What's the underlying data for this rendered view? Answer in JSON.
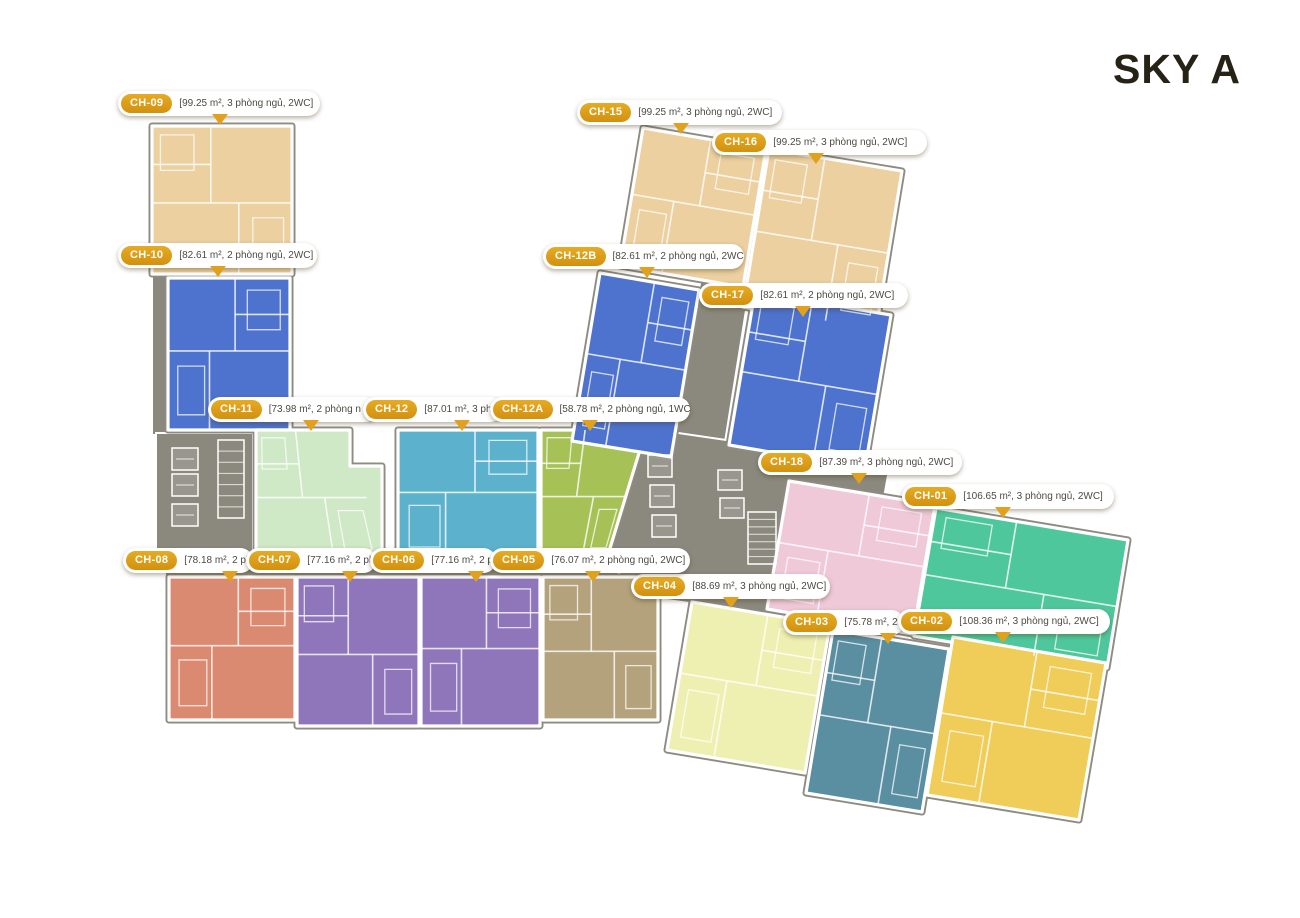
{
  "title": {
    "text": "SKY A"
  },
  "palette": {
    "pill": "#dd9e14",
    "arrow": "#e2a11c",
    "bubble_text": "#4d4a42",
    "core": "#8b897e",
    "outline": "#8e8c82",
    "wall": "#ffffff",
    "background": "#ffffff"
  },
  "units": [
    {
      "id": "CH-09",
      "color": "#ecd0a0",
      "points": [
        [
          152,
          126
        ],
        [
          292,
          126
        ],
        [
          292,
          274
        ],
        [
          152,
          274
        ]
      ]
    },
    {
      "id": "CH-10",
      "color": "#4e73cf",
      "points": [
        [
          168,
          278
        ],
        [
          290,
          278
        ],
        [
          290,
          430
        ],
        [
          168,
          430
        ]
      ]
    },
    {
      "id": "CH-11",
      "color": "#cfe8c6",
      "points": [
        [
          256,
          430
        ],
        [
          350,
          430
        ],
        [
          350,
          466
        ],
        [
          382,
          466
        ],
        [
          382,
          560
        ],
        [
          256,
          560
        ]
      ]
    },
    {
      "id": "CH-12",
      "color": "#5cb2cd",
      "points": [
        [
          398,
          430
        ],
        [
          538,
          430
        ],
        [
          538,
          560
        ],
        [
          398,
          560
        ]
      ]
    },
    {
      "id": "CH-12A",
      "color": "#a6c257",
      "points": [
        [
          541,
          430
        ],
        [
          646,
          430
        ],
        [
          607,
          558
        ],
        [
          541,
          558
        ]
      ]
    },
    {
      "id": "CH-08",
      "color": "#db8a72",
      "points": [
        [
          169,
          577
        ],
        [
          295,
          577
        ],
        [
          295,
          720
        ],
        [
          169,
          720
        ]
      ]
    },
    {
      "id": "CH-07",
      "color": "#8f76ba",
      "points": [
        [
          297,
          577
        ],
        [
          419,
          577
        ],
        [
          419,
          726
        ],
        [
          297,
          726
        ]
      ]
    },
    {
      "id": "CH-06",
      "color": "#8f76ba",
      "points": [
        [
          421,
          577
        ],
        [
          540,
          577
        ],
        [
          540,
          726
        ],
        [
          421,
          726
        ]
      ]
    },
    {
      "id": "CH-05",
      "color": "#b4a27c",
      "points": [
        [
          543,
          577
        ],
        [
          658,
          577
        ],
        [
          658,
          720
        ],
        [
          543,
          720
        ]
      ]
    },
    {
      "id": "CH-15",
      "color": "#ecd0a0",
      "points": [
        [
          643,
          128
        ],
        [
          766,
          149
        ],
        [
          743,
          287
        ],
        [
          620,
          266
        ]
      ]
    },
    {
      "id": "CH-16",
      "color": "#ecd0a0",
      "points": [
        [
          769,
          149
        ],
        [
          902,
          171
        ],
        [
          876,
          329
        ],
        [
          743,
          307
        ]
      ]
    },
    {
      "id": "CH-12B",
      "color": "#4e73cf",
      "points": [
        [
          600,
          273
        ],
        [
          699,
          290
        ],
        [
          671,
          457
        ],
        [
          572,
          441
        ]
      ]
    },
    {
      "id": "CH-17",
      "color": "#4e73cf",
      "points": [
        [
          755,
          292
        ],
        [
          891,
          315
        ],
        [
          865,
          468
        ],
        [
          729,
          445
        ]
      ]
    },
    {
      "id": "CH-18",
      "color": "#f0c9d8",
      "points": [
        [
          789,
          481
        ],
        [
          935,
          505
        ],
        [
          913,
          634
        ],
        [
          767,
          609
        ]
      ]
    },
    {
      "id": "CH-01",
      "color": "#4fc79c",
      "points": [
        [
          936,
          508
        ],
        [
          1128,
          540
        ],
        [
          1107,
          668
        ],
        [
          914,
          636
        ]
      ]
    },
    {
      "id": "CH-04",
      "color": "#eef0b2",
      "points": [
        [
          692,
          602
        ],
        [
          830,
          625
        ],
        [
          805,
          773
        ],
        [
          667,
          750
        ]
      ]
    },
    {
      "id": "CH-03",
      "color": "#5a8ea1",
      "points": [
        [
          833,
          630
        ],
        [
          949,
          649
        ],
        [
          922,
          812
        ],
        [
          806,
          793
        ]
      ]
    },
    {
      "id": "CH-02",
      "color": "#efcd58",
      "points": [
        [
          953,
          637
        ],
        [
          1106,
          663
        ],
        [
          1079,
          820
        ],
        [
          927,
          795
        ]
      ]
    }
  ],
  "cores": [
    {
      "name": "corridor-left",
      "points": [
        [
          152,
          248
        ],
        [
          168,
          248
        ],
        [
          168,
          435
        ],
        [
          152,
          435
        ]
      ]
    },
    {
      "name": "core-left",
      "points": [
        [
          156,
          433
        ],
        [
          253,
          433
        ],
        [
          253,
          568
        ],
        [
          156,
          568
        ]
      ]
    },
    {
      "name": "corridor-band-left",
      "points": [
        [
          165,
          560
        ],
        [
          645,
          560
        ],
        [
          645,
          578
        ],
        [
          165,
          578
        ]
      ]
    },
    {
      "name": "corridor-right",
      "points": [
        [
          701,
          277
        ],
        [
          750,
          285
        ],
        [
          712,
          524
        ],
        [
          663,
          516
        ]
      ]
    },
    {
      "name": "core-center",
      "points": [
        [
          644,
          428
        ],
        [
          890,
          464
        ],
        [
          880,
          520
        ],
        [
          770,
          614
        ],
        [
          645,
          597
        ],
        [
          600,
          556
        ]
      ]
    }
  ],
  "core_details": {
    "elevators": [
      [
        172,
        448,
        26,
        22
      ],
      [
        172,
        474,
        26,
        22
      ],
      [
        172,
        504,
        26,
        22
      ],
      [
        648,
        455,
        24,
        22
      ],
      [
        650,
        485,
        24,
        22
      ],
      [
        652,
        515,
        24,
        22
      ],
      [
        718,
        470,
        24,
        20
      ],
      [
        720,
        498,
        24,
        20
      ]
    ],
    "stairs": [
      [
        218,
        440,
        26,
        78
      ],
      [
        748,
        512,
        28,
        52
      ]
    ]
  },
  "labels": [
    {
      "unit": "CH-09",
      "pill": "CH-09",
      "info": "[99.25 m², 3 phòng ngủ, 2WC]",
      "x": 118,
      "y": 91,
      "w": 202,
      "arrow": 102,
      "z": 10
    },
    {
      "unit": "CH-15",
      "pill": "CH-15",
      "info": "[99.25 m², 3 phòng ngủ, 2WC]",
      "x": 577,
      "y": 100,
      "w": 205,
      "arrow": 104,
      "z": 10
    },
    {
      "unit": "CH-16",
      "pill": "CH-16",
      "info": "[99.25 m², 3 phòng ngủ, 2WC]",
      "x": 712,
      "y": 130,
      "w": 215,
      "arrow": 104,
      "z": 10
    },
    {
      "unit": "CH-10",
      "pill": "CH-10",
      "info": "[82.61 m², 2 phòng ngủ, 2WC]",
      "x": 118,
      "y": 243,
      "w": 199,
      "arrow": 100,
      "z": 10
    },
    {
      "unit": "CH-12B",
      "pill": "CH-12B",
      "info": "[82.61 m², 2 phòng ngủ, 2WC]",
      "x": 543,
      "y": 244,
      "w": 201,
      "arrow": 104,
      "z": 10
    },
    {
      "unit": "CH-17",
      "pill": "CH-17",
      "info": "[82.61 m², 2 phòng ngủ, 2WC]",
      "x": 699,
      "y": 283,
      "w": 209,
      "arrow": 104,
      "z": 10
    },
    {
      "unit": "CH-11",
      "pill": "CH-11",
      "info": "[73.98 m², 2 phòng n",
      "x": 208,
      "y": 397,
      "w": 170,
      "arrow": 103,
      "z": 11
    },
    {
      "unit": "CH-12",
      "pill": "CH-12",
      "info": "[87.01 m², 3 phò",
      "x": 363,
      "y": 397,
      "w": 140,
      "arrow": 99,
      "z": 12
    },
    {
      "unit": "CH-12A",
      "pill": "CH-12A",
      "info": "[58.78 m², 2 phòng ngủ, 1WC]",
      "x": 490,
      "y": 397,
      "w": 200,
      "arrow": 100,
      "z": 13
    },
    {
      "unit": "CH-18",
      "pill": "CH-18",
      "info": "[87.39 m², 3 phòng ngủ, 2WC]",
      "x": 758,
      "y": 450,
      "w": 204,
      "arrow": 101,
      "z": 10
    },
    {
      "unit": "CH-01",
      "pill": "CH-01",
      "info": "[106.65 m², 3 phòng ngủ, 2WC]",
      "x": 902,
      "y": 484,
      "w": 212,
      "arrow": 101,
      "z": 10
    },
    {
      "unit": "CH-08",
      "pill": "CH-08",
      "info": "[78.18 m², 2 ph",
      "x": 123,
      "y": 548,
      "w": 130,
      "arrow": 107,
      "z": 11
    },
    {
      "unit": "CH-07",
      "pill": "CH-07",
      "info": "[77.16 m², 2 ph",
      "x": 246,
      "y": 548,
      "w": 130,
      "arrow": 104,
      "z": 12
    },
    {
      "unit": "CH-06",
      "pill": "CH-06",
      "info": "[77.16 m², 2 p",
      "x": 370,
      "y": 548,
      "w": 126,
      "arrow": 106,
      "z": 13
    },
    {
      "unit": "CH-05",
      "pill": "CH-05",
      "info": "[76.07 m², 2 phòng ngủ, 2WC]",
      "x": 490,
      "y": 548,
      "w": 200,
      "arrow": 103,
      "z": 14
    },
    {
      "unit": "CH-04",
      "pill": "CH-04",
      "info": "[88.69 m², 3 phòng ngủ, 2WC]",
      "x": 631,
      "y": 574,
      "w": 199,
      "arrow": 100,
      "z": 10
    },
    {
      "unit": "CH-03",
      "pill": "CH-03",
      "info": "[75.78 m², 2",
      "x": 783,
      "y": 610,
      "w": 121,
      "arrow": 105,
      "z": 11
    },
    {
      "unit": "CH-02",
      "pill": "CH-02",
      "info": "[108.36 m², 3 phòng ngủ, 2WC]",
      "x": 898,
      "y": 609,
      "w": 212,
      "arrow": 105,
      "z": 12
    }
  ]
}
